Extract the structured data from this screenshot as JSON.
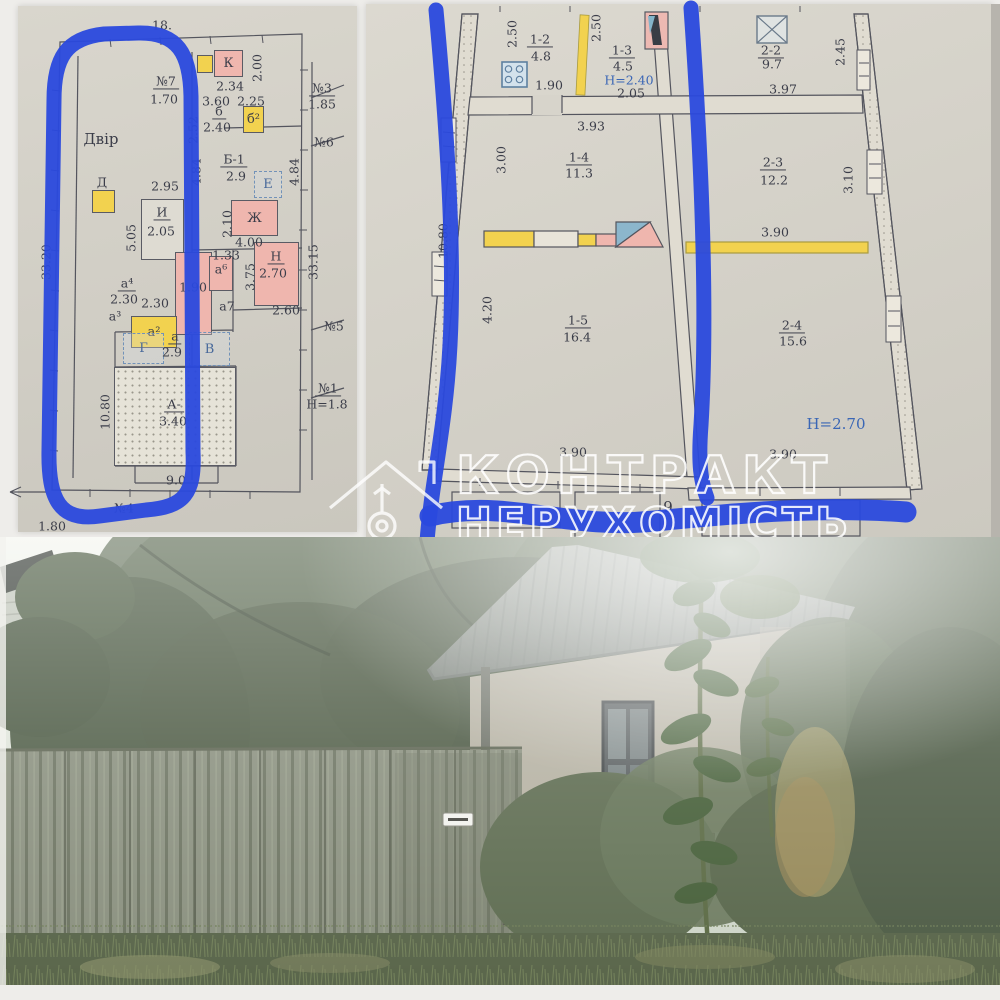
{
  "watermark": {
    "brand_line1": "КОНТРАКТ",
    "brand_line2": "НЕРУХОМІСТЬ"
  },
  "colors": {
    "marker_blue": "#2a49dd",
    "room_pink": "#efb6ae",
    "room_yellow": "#f2d24f",
    "height_note_blue": "#3a66b5",
    "paper": "#d4d1c8"
  },
  "icons": {
    "logo": "house-key",
    "stove": "gas-stove-grid",
    "window": "window-cross",
    "bath": "bathtub"
  },
  "left_plan": {
    "labels": [
      {
        "t": "18.",
        "x": 162,
        "y": 25
      },
      {
        "t": "№7",
        "x": 166,
        "y": 82,
        "u": 1
      },
      {
        "t": "1.70",
        "x": 164,
        "y": 99
      },
      {
        "t": "Двір",
        "x": 101,
        "y": 140,
        "s": "lg"
      },
      {
        "t": "Д",
        "x": 102,
        "y": 182
      },
      {
        "t": "2.95",
        "x": 165,
        "y": 186
      },
      {
        "t": "И",
        "x": 162,
        "y": 213,
        "u": 1
      },
      {
        "t": "2.05",
        "x": 161,
        "y": 231
      },
      {
        "t": "5.05",
        "x": 131,
        "y": 238,
        "r": 1
      },
      {
        "t": "33.20",
        "x": 46,
        "y": 262,
        "r": 1
      },
      {
        "t": "2.52",
        "x": 193,
        "y": 130,
        "r": 1
      },
      {
        "t": "4.84",
        "x": 196,
        "y": 172,
        "r": 1
      },
      {
        "t": "4.84",
        "x": 294,
        "y": 172,
        "r": 1
      },
      {
        "t": "2.34",
        "x": 230,
        "y": 86
      },
      {
        "t": "2.00",
        "x": 257,
        "y": 68,
        "r": 1
      },
      {
        "t": "3.60",
        "x": 216,
        "y": 101
      },
      {
        "t": "2.25",
        "x": 251,
        "y": 101
      },
      {
        "t": "б",
        "x": 219,
        "y": 112,
        "u": 1
      },
      {
        "t": "2.40",
        "x": 217,
        "y": 127
      },
      {
        "t": "№3",
        "x": 322,
        "y": 89,
        "u": 1
      },
      {
        "t": "1.85",
        "x": 322,
        "y": 104
      },
      {
        "t": "№6",
        "x": 324,
        "y": 142
      },
      {
        "t": "Б-1",
        "x": 234,
        "y": 160,
        "u": 1
      },
      {
        "t": "2.9",
        "x": 236,
        "y": 176
      },
      {
        "t": "2.10",
        "x": 227,
        "y": 224,
        "r": 1
      },
      {
        "t": "4.00",
        "x": 249,
        "y": 242
      },
      {
        "t": "Н",
        "x": 276,
        "y": 257,
        "u": 1
      },
      {
        "t": "2.70",
        "x": 273,
        "y": 273
      },
      {
        "t": "3.75",
        "x": 250,
        "y": 277,
        "r": 1
      },
      {
        "t": "33.15",
        "x": 313,
        "y": 262,
        "r": 1
      },
      {
        "t": "1.33",
        "x": 226,
        "y": 255
      },
      {
        "t": "1.90",
        "x": 193,
        "y": 287
      },
      {
        "t": "а⁶",
        "x": 221,
        "y": 269
      },
      {
        "t": "а7",
        "x": 227,
        "y": 306
      },
      {
        "t": "а⁴",
        "x": 127,
        "y": 284,
        "u": 1
      },
      {
        "t": "2.30",
        "x": 124,
        "y": 299
      },
      {
        "t": "2.30",
        "x": 155,
        "y": 303
      },
      {
        "t": "а³",
        "x": 115,
        "y": 316
      },
      {
        "t": "2.60",
        "x": 286,
        "y": 310
      },
      {
        "t": "№5",
        "x": 334,
        "y": 326
      },
      {
        "t": "а",
        "x": 175,
        "y": 337,
        "u": 1
      },
      {
        "t": "2.9",
        "x": 172,
        "y": 352
      },
      {
        "t": "10.80",
        "x": 105,
        "y": 412,
        "r": 1
      },
      {
        "t": "А-",
        "x": 174,
        "y": 405,
        "u": 1
      },
      {
        "t": "3.40",
        "x": 173,
        "y": 421
      },
      {
        "t": "9.0",
        "x": 176,
        "y": 480
      },
      {
        "t": "№1",
        "x": 328,
        "y": 389,
        "u": 1
      },
      {
        "t": "Н=1.8",
        "x": 327,
        "y": 404
      },
      {
        "t": "№4",
        "x": 124,
        "y": 508
      },
      {
        "t": "1.80",
        "x": 52,
        "y": 526
      }
    ],
    "boxes": [
      {
        "t": "К",
        "x": 214,
        "y": 50,
        "w": 29,
        "h": 27,
        "f": "p"
      },
      {
        "t": "",
        "x": 197,
        "y": 55,
        "w": 16,
        "h": 18,
        "f": "y"
      },
      {
        "t": "б²",
        "x": 243,
        "y": 106,
        "w": 21,
        "h": 27,
        "f": "y"
      },
      {
        "t": "Е",
        "x": 254,
        "y": 171,
        "w": 28,
        "h": 27,
        "f": "d"
      },
      {
        "t": "Ж",
        "x": 231,
        "y": 200,
        "w": 47,
        "h": 36,
        "f": "p"
      },
      {
        "t": "",
        "x": 254,
        "y": 242,
        "w": 45,
        "h": 64,
        "f": "p"
      },
      {
        "t": "",
        "x": 141,
        "y": 199,
        "w": 43,
        "h": 61,
        "f": "w"
      },
      {
        "t": "",
        "x": 175,
        "y": 252,
        "w": 37,
        "h": 83,
        "f": "p"
      },
      {
        "t": "",
        "x": 209,
        "y": 256,
        "w": 24,
        "h": 35,
        "f": "p"
      },
      {
        "t": "а²",
        "x": 131,
        "y": 316,
        "w": 46,
        "h": 32,
        "f": "y"
      },
      {
        "t": "",
        "x": 92,
        "y": 190,
        "w": 23,
        "h": 23,
        "f": "y"
      },
      {
        "t": "Г",
        "x": 123,
        "y": 333,
        "w": 41,
        "h": 31,
        "f": "d"
      },
      {
        "t": "В",
        "x": 189,
        "y": 332,
        "w": 41,
        "h": 34,
        "f": "d"
      },
      {
        "t": "",
        "x": 114,
        "y": 367,
        "w": 122,
        "h": 99,
        "f": "dot"
      }
    ]
  },
  "right_plan": {
    "labels": [
      {
        "t": "2.50",
        "x": 512,
        "y": 34,
        "r": 1
      },
      {
        "t": "1-2",
        "x": 540,
        "y": 40,
        "u": 1
      },
      {
        "t": "4.8",
        "x": 541,
        "y": 56
      },
      {
        "t": "1.90",
        "x": 549,
        "y": 85
      },
      {
        "t": "2.50",
        "x": 596,
        "y": 28,
        "r": 1
      },
      {
        "t": "1-3",
        "x": 622,
        "y": 51,
        "u": 1
      },
      {
        "t": "4.5",
        "x": 623,
        "y": 66
      },
      {
        "t": "Н=2.40",
        "x": 629,
        "y": 80,
        "b": 1
      },
      {
        "t": "2.05",
        "x": 631,
        "y": 93
      },
      {
        "t": "3.93",
        "x": 591,
        "y": 126
      },
      {
        "t": "2-2",
        "x": 771,
        "y": 51,
        "u": 1
      },
      {
        "t": "9.7",
        "x": 772,
        "y": 64
      },
      {
        "t": "2.45",
        "x": 840,
        "y": 52,
        "r": 1
      },
      {
        "t": "3.97",
        "x": 783,
        "y": 89
      },
      {
        "t": "3.00",
        "x": 501,
        "y": 160,
        "r": 1
      },
      {
        "t": "1-4",
        "x": 579,
        "y": 158,
        "u": 1
      },
      {
        "t": "11.3",
        "x": 579,
        "y": 173
      },
      {
        "t": "10.80",
        "x": 443,
        "y": 241,
        "r": 1
      },
      {
        "t": "2-3",
        "x": 773,
        "y": 163,
        "u": 1
      },
      {
        "t": "12.2",
        "x": 774,
        "y": 180
      },
      {
        "t": "3.10",
        "x": 848,
        "y": 180,
        "r": 1
      },
      {
        "t": "3.90",
        "x": 775,
        "y": 232
      },
      {
        "t": "4.20",
        "x": 487,
        "y": 310,
        "r": 1
      },
      {
        "t": "1-5",
        "x": 578,
        "y": 321,
        "u": 1
      },
      {
        "t": "16.4",
        "x": 577,
        "y": 337
      },
      {
        "t": "2-4",
        "x": 792,
        "y": 326,
        "u": 1
      },
      {
        "t": "15.6",
        "x": 793,
        "y": 341
      },
      {
        "t": "Н=2.70",
        "x": 836,
        "y": 425,
        "b": 1,
        "s": "lg"
      },
      {
        "t": "3.90",
        "x": 573,
        "y": 452
      },
      {
        "t": "3.90",
        "x": 783,
        "y": 454
      },
      {
        "t": "9",
        "x": 668,
        "y": 508,
        "s": "lg"
      }
    ]
  }
}
